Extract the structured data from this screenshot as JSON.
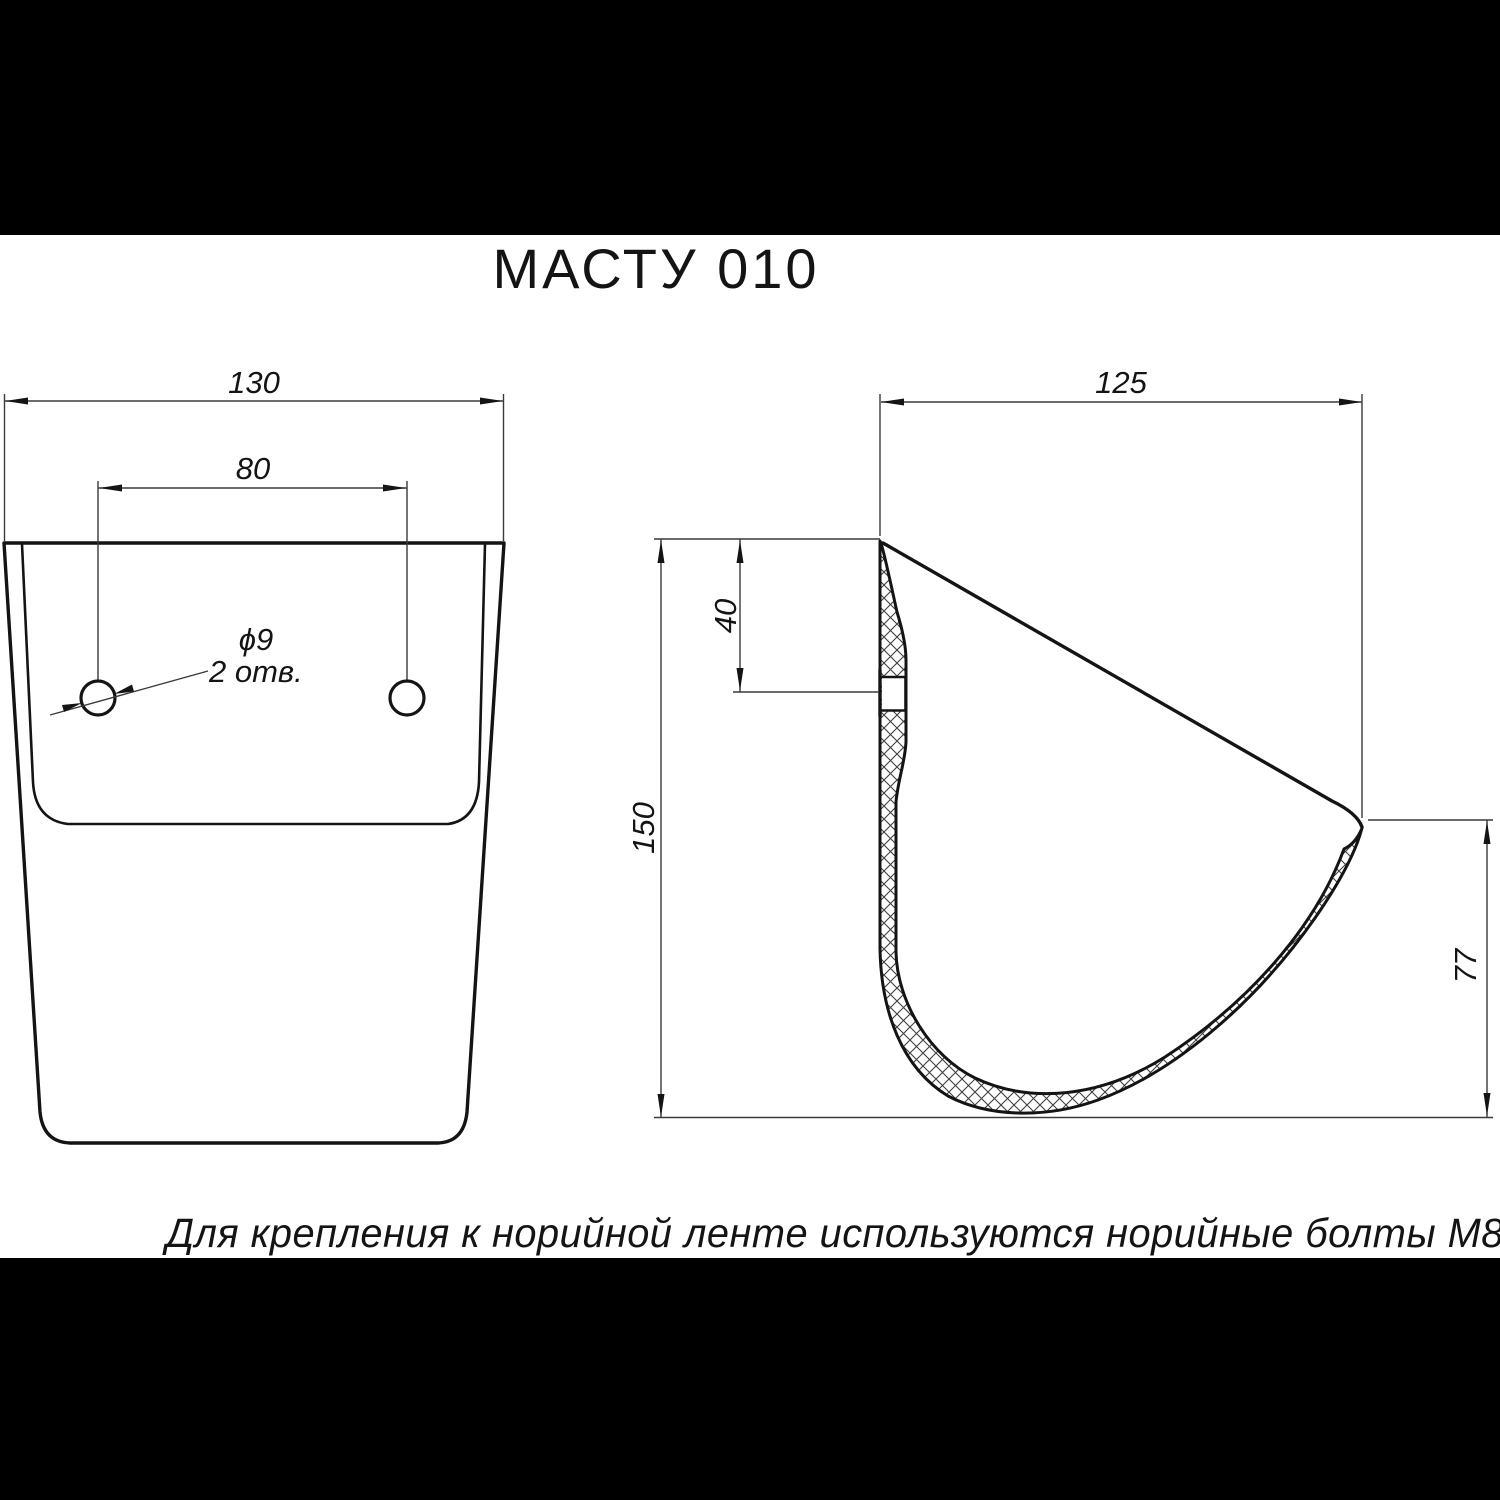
{
  "title": "МАСТУ 010",
  "note": "Для крепления к норийной ленте используются норийные болты М8х32",
  "views": {
    "front": {
      "width_mm": "130",
      "hole_spacing_mm": "80",
      "hole_diameter": "ϕ9",
      "hole_count": "2 отв."
    },
    "side": {
      "depth_mm": "125",
      "hole_offset_mm": "40",
      "height_mm": "150",
      "lip_height_mm": "77"
    }
  },
  "colors": {
    "paper": "#ffffff",
    "ink": "#141414",
    "thin_line": "#3a3a3a",
    "letterbox": "#000000"
  }
}
